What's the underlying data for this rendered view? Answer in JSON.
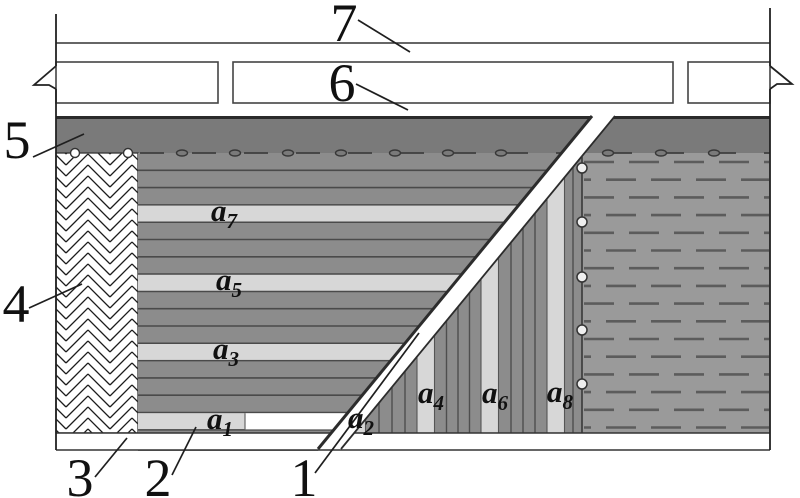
{
  "diagram": {
    "ref_labels": {
      "l1": "1",
      "l2": "2",
      "l3": "3",
      "l4": "4",
      "l5": "5",
      "l6": "6",
      "l7": "7"
    },
    "layer_labels": {
      "a1": {
        "base": "a",
        "sub": "1"
      },
      "a2": {
        "base": "a",
        "sub": "2"
      },
      "a3": {
        "base": "a",
        "sub": "3"
      },
      "a4": {
        "base": "a",
        "sub": "4"
      },
      "a5": {
        "base": "a",
        "sub": "5"
      },
      "a6": {
        "base": "a",
        "sub": "6"
      },
      "a7": {
        "base": "a",
        "sub": "7"
      },
      "a8": {
        "base": "a",
        "sub": "8"
      }
    },
    "colors": {
      "roof_band_gray": "#7a7a7a",
      "region_gray": "#8c8c8c",
      "right_region_gray": "#9a9a9a",
      "light_layer_band": "#d7d7d7",
      "stripe_line": "#4e4e4e",
      "outline": "#2e2e2e",
      "background": "#ffffff"
    }
  }
}
